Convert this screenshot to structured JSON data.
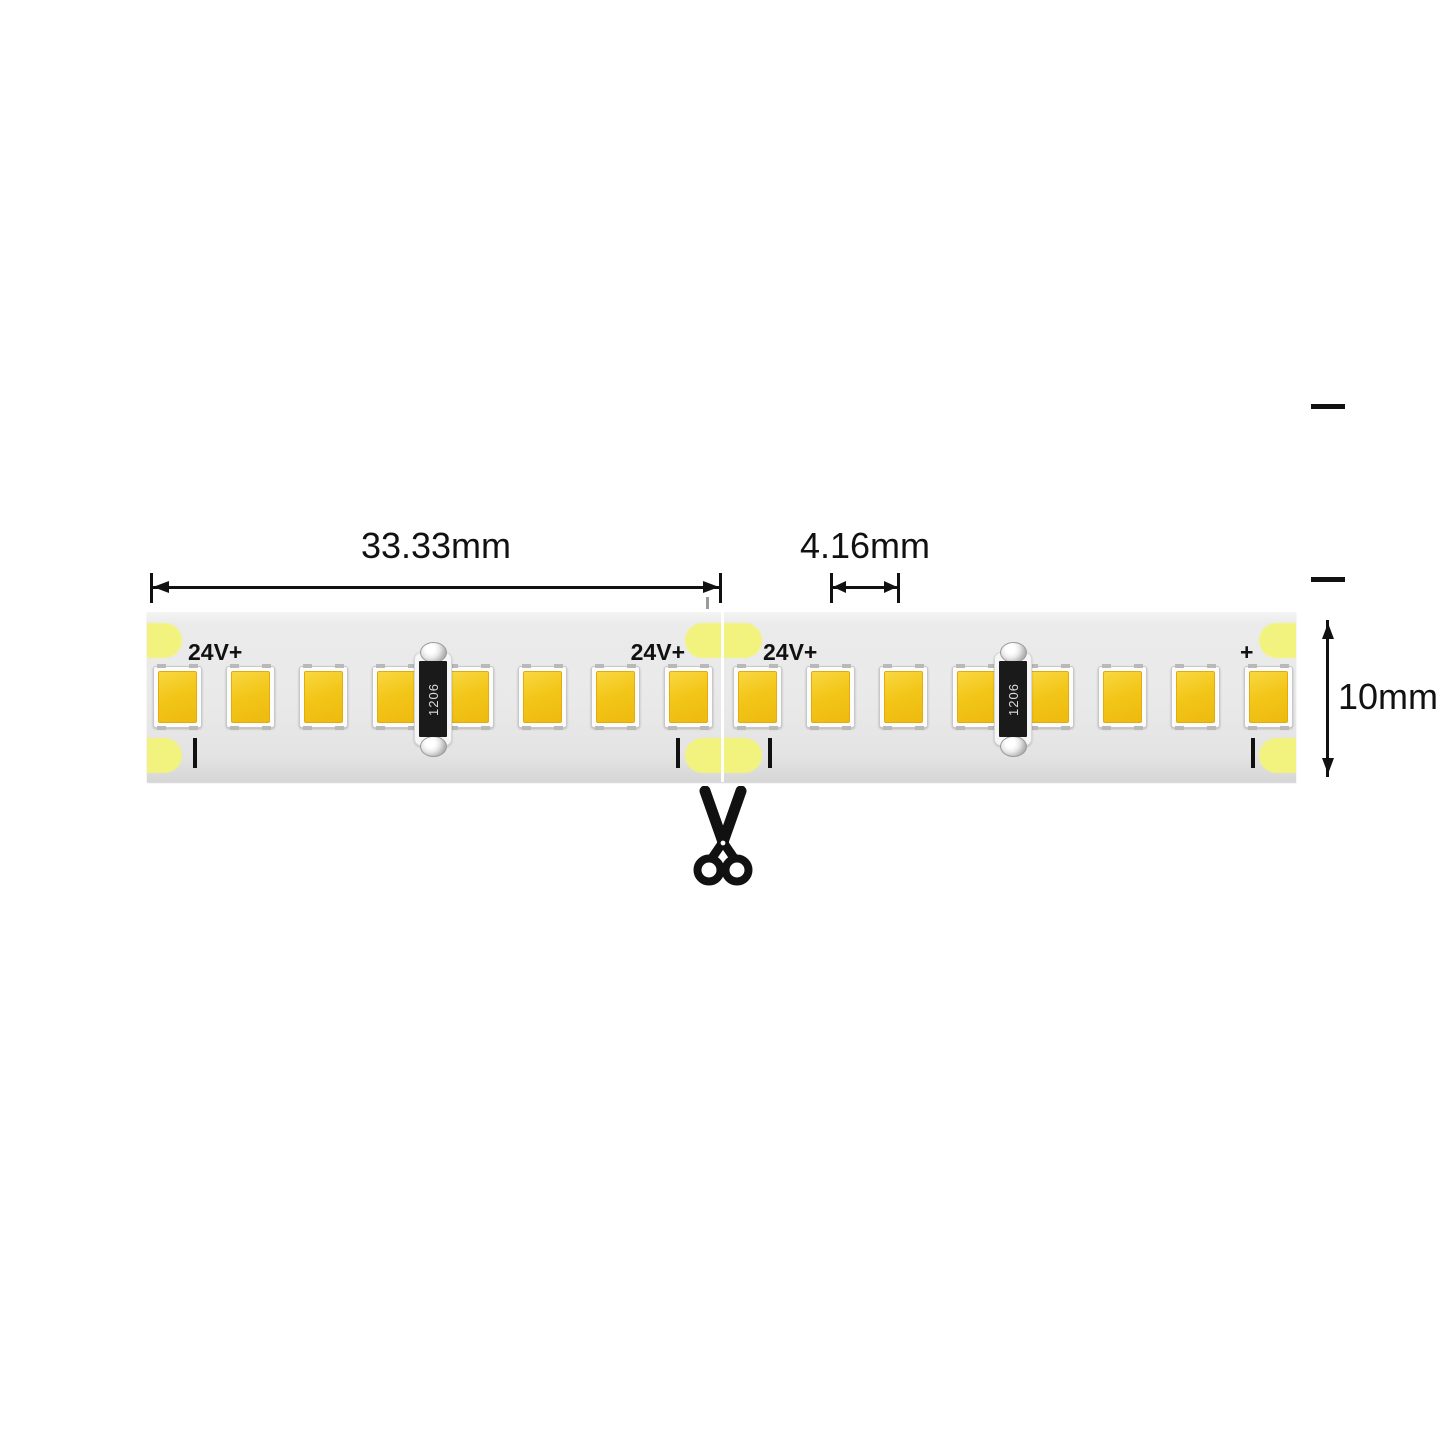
{
  "diagram": {
    "subject": "led-strip-cut-length-diagram",
    "dimensions": {
      "segment_length": {
        "label": "33.33mm"
      },
      "led_pitch": {
        "label": "4.16mm"
      },
      "strip_width": {
        "label": "10mm"
      }
    },
    "strip": {
      "segment_count": 2,
      "leds_per_segment": 8,
      "resistors_per_segment": 1,
      "resistor_after_led_index": 4,
      "resistor_code": "1206",
      "polarity_labels": [
        {
          "id": "left-end",
          "text": "24V+"
        },
        {
          "id": "before-cut",
          "text": "24V+"
        },
        {
          "id": "after-cut",
          "text": "24V+"
        },
        {
          "id": "right-end",
          "text": "+"
        }
      ],
      "minus_mark_count": 4,
      "solder_pad_count": 6,
      "cut_point_icon": "scissors-icon"
    },
    "colors": {
      "led_yellow": "#F0BF12",
      "solder_pad_yellow": "#F2F37E",
      "pcb_gray": "#E9E9E9",
      "annotation_black": "#111111"
    }
  }
}
